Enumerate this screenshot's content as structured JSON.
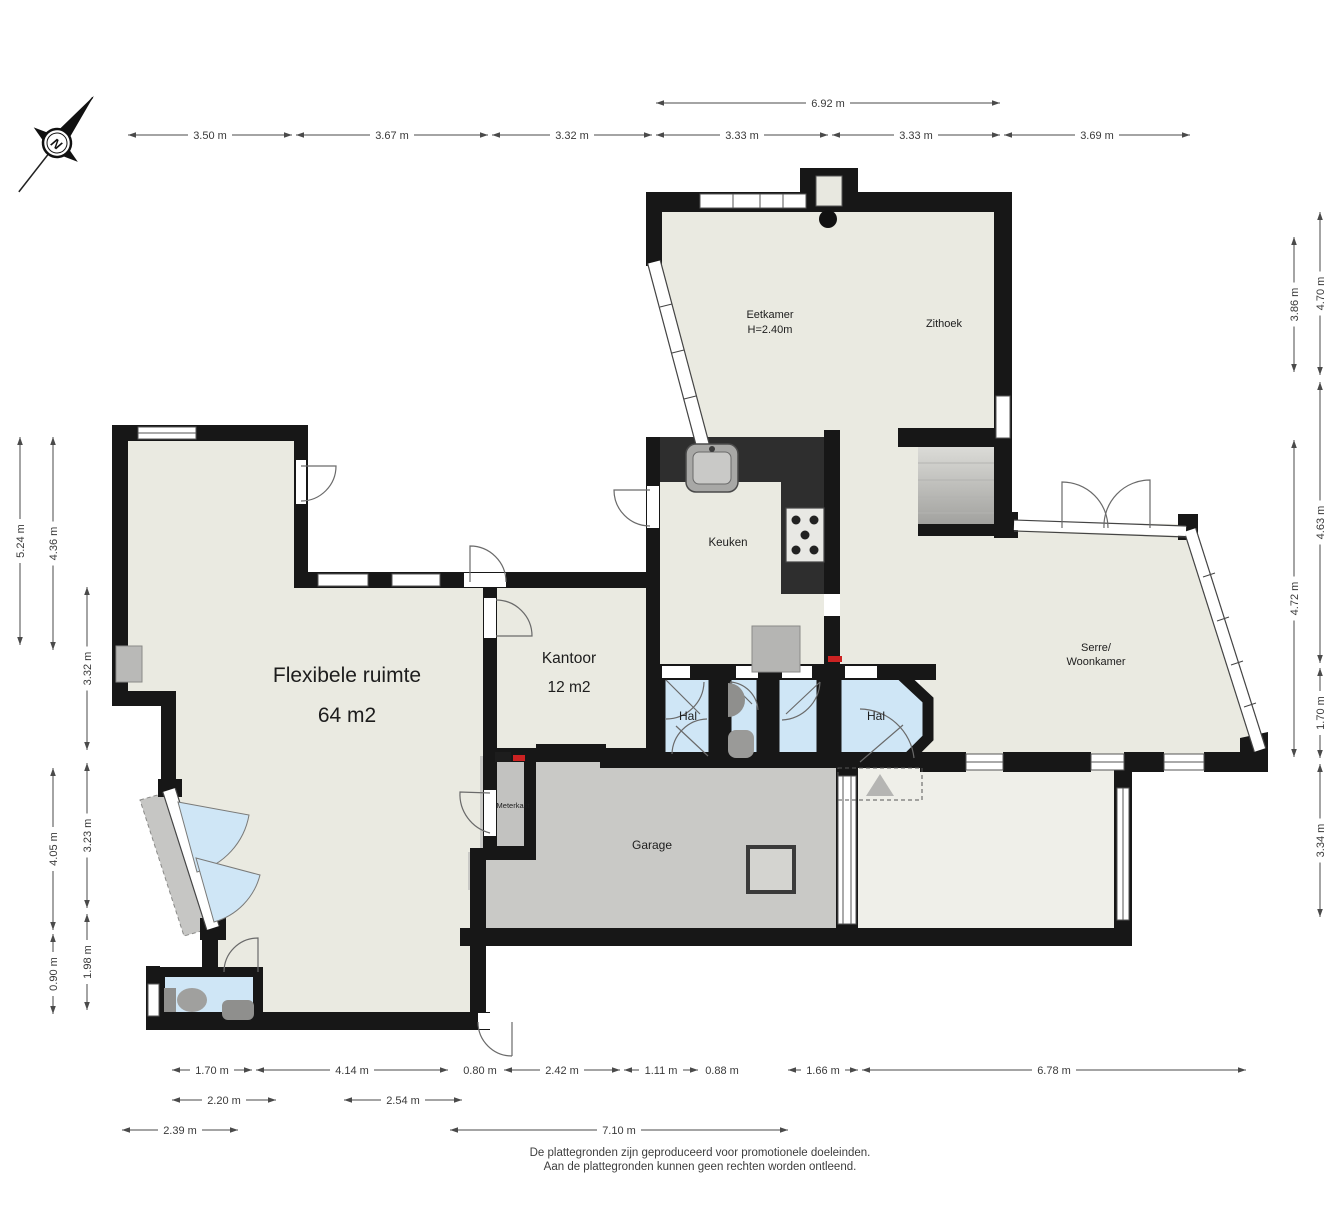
{
  "title": "Floor plan (begane grond)",
  "compass": {
    "label": "N"
  },
  "colors": {
    "wall": "#171717",
    "floor": "#eaeae1",
    "blue_room": "#cfe6f6",
    "garage_gray": "#c9c9c6",
    "meterkast_gray": "#c2c2c0",
    "counter_dark": "#2e2e2e",
    "dim_line": "#4a4a4a",
    "red_marker": "#cc2222"
  },
  "rooms": [
    {
      "id": "eetkamer",
      "label": "Eetkamer",
      "sub": "H=2.40m",
      "x": 770,
      "y": 318,
      "size": 11,
      "subdy": 15
    },
    {
      "id": "zithoek",
      "label": "Zithoek",
      "sub": "",
      "x": 944,
      "y": 327,
      "size": 11,
      "subdy": 0
    },
    {
      "id": "keuken",
      "label": "Keuken",
      "sub": "",
      "x": 728,
      "y": 546,
      "size": 11.5,
      "subdy": 0
    },
    {
      "id": "kantoor",
      "label": "Kantoor",
      "sub": "12 m2",
      "x": 569,
      "y": 663,
      "size": 15.5,
      "subdy": 29
    },
    {
      "id": "flexibele-ruimte",
      "label": "Flexibele ruimte",
      "sub": "64 m2",
      "x": 347,
      "y": 682,
      "size": 21,
      "subdy": 40
    },
    {
      "id": "hal-1",
      "label": "Hal",
      "sub": "",
      "x": 688,
      "y": 720,
      "size": 12,
      "subdy": 0
    },
    {
      "id": "hal-2",
      "label": "Hal",
      "sub": "",
      "x": 876,
      "y": 720,
      "size": 12,
      "subdy": 0
    },
    {
      "id": "serre-woonkamer",
      "label": "Serre/",
      "sub": "Woonkamer",
      "x": 1096,
      "y": 651,
      "size": 11,
      "subdy": 14
    },
    {
      "id": "garage",
      "label": "Garage",
      "sub": "",
      "x": 652,
      "y": 849,
      "size": 12,
      "subdy": 0
    },
    {
      "id": "meterkast",
      "label": "Meterkast",
      "sub": "",
      "x": 513,
      "y": 808,
      "size": 7.5,
      "subdy": 0
    }
  ],
  "dimensions": {
    "horizontal": [
      {
        "label": "3.50 m",
        "x1": 128,
        "x2": 292,
        "y": 135
      },
      {
        "label": "3.67 m",
        "x1": 296,
        "x2": 488,
        "y": 135
      },
      {
        "label": "3.32 m",
        "x1": 492,
        "x2": 652,
        "y": 135
      },
      {
        "label": "3.33 m",
        "x1": 656,
        "x2": 828,
        "y": 135
      },
      {
        "label": "3.33 m",
        "x1": 832,
        "x2": 1000,
        "y": 135
      },
      {
        "label": "3.69 m",
        "x1": 1004,
        "x2": 1190,
        "y": 135
      },
      {
        "label": "6.92 m",
        "x1": 656,
        "x2": 1000,
        "y": 103
      },
      {
        "label": "1.70 m",
        "x1": 172,
        "x2": 252,
        "y": 1070
      },
      {
        "label": "4.14 m",
        "x1": 256,
        "x2": 448,
        "y": 1070
      },
      {
        "label": "0.80 m",
        "x1": 460,
        "x2": 500,
        "y": 1070
      },
      {
        "label": "2.42 m",
        "x1": 504,
        "x2": 620,
        "y": 1070
      },
      {
        "label": "1.11 m",
        "x1": 624,
        "x2": 698,
        "y": 1070
      },
      {
        "label": "0.88 m",
        "x1": 702,
        "x2": 742,
        "y": 1070
      },
      {
        "label": "1.66 m",
        "x1": 788,
        "x2": 858,
        "y": 1070
      },
      {
        "label": "6.78 m",
        "x1": 862,
        "x2": 1246,
        "y": 1070
      },
      {
        "label": "2.20 m",
        "x1": 172,
        "x2": 276,
        "y": 1100
      },
      {
        "label": "2.54 m",
        "x1": 344,
        "x2": 462,
        "y": 1100
      },
      {
        "label": "2.39 m",
        "x1": 122,
        "x2": 238,
        "y": 1130
      },
      {
        "label": "7.10 m",
        "x1": 450,
        "x2": 788,
        "y": 1130
      }
    ],
    "vertical": [
      {
        "label": "5.24 m",
        "y1": 437,
        "y2": 645,
        "x": 20
      },
      {
        "label": "4.36 m",
        "y1": 437,
        "y2": 650,
        "x": 53
      },
      {
        "label": "4.05 m",
        "y1": 768,
        "y2": 930,
        "x": 53
      },
      {
        "label": "0.90 m",
        "y1": 934,
        "y2": 1014,
        "x": 53
      },
      {
        "label": "3.32 m",
        "y1": 587,
        "y2": 750,
        "x": 87
      },
      {
        "label": "3.23 m",
        "y1": 763,
        "y2": 908,
        "x": 87
      },
      {
        "label": "1.98 m",
        "y1": 914,
        "y2": 1010,
        "x": 87
      },
      {
        "label": "3.86 m",
        "y1": 237,
        "y2": 372,
        "x": 1294
      },
      {
        "label": "4.72 m",
        "y1": 440,
        "y2": 757,
        "x": 1294
      },
      {
        "label": "4.70 m",
        "y1": 212,
        "y2": 375,
        "x": 1320
      },
      {
        "label": "4.63 m",
        "y1": 382,
        "y2": 663,
        "x": 1320
      },
      {
        "label": "1.70 m",
        "y1": 668,
        "y2": 758,
        "x": 1320
      },
      {
        "label": "3.34 m",
        "y1": 764,
        "y2": 917,
        "x": 1320
      }
    ]
  },
  "footer": {
    "line1": "De plattegronden zijn geproduceerd voor promotionele doeleinden.",
    "line2": "Aan de plattegronden kunnen geen rechten worden ontleend."
  }
}
